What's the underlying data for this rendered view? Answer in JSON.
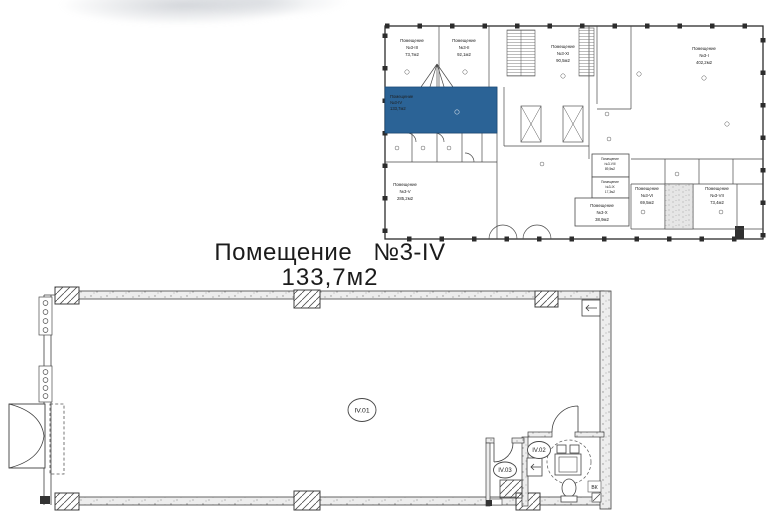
{
  "overview": {
    "highlight_color": "#2B6396",
    "rooms": [
      {
        "label": "Помещение",
        "number": "№3-III",
        "area": "73,7м2"
      },
      {
        "label": "Помещение",
        "number": "№3-II",
        "area": "92,1м2"
      },
      {
        "label": "Помещение",
        "number": "№3-XI",
        "area": "90,5м2"
      },
      {
        "label": "Помещение",
        "number": "№3-I",
        "area": "402,2м2"
      },
      {
        "label": "Помещение",
        "number": "№3-IV",
        "area": "133,7м2"
      },
      {
        "label": "Помещение",
        "number": "№3-V",
        "area": "285,2м2"
      },
      {
        "label": "Помещение",
        "number": "№3-VIII",
        "area": "89,5м2"
      },
      {
        "label": "Помещение",
        "number": "№3-IX",
        "area": "17,3м2"
      },
      {
        "label": "Помещение",
        "number": "№3-X",
        "area": "38,9м2"
      },
      {
        "label": "Помещение",
        "number": "№3-VI",
        "area": "69,5м2"
      },
      {
        "label": "Помещение",
        "number": "№3-VII",
        "area": "73,4м2"
      }
    ]
  },
  "title": {
    "room": "Помещение №3-IV",
    "area": "133,7м2"
  },
  "detail": {
    "rooms": [
      {
        "id": "IV.01"
      },
      {
        "id": "IV.02"
      },
      {
        "id": "IV.03"
      }
    ],
    "annotation": "ВК"
  }
}
